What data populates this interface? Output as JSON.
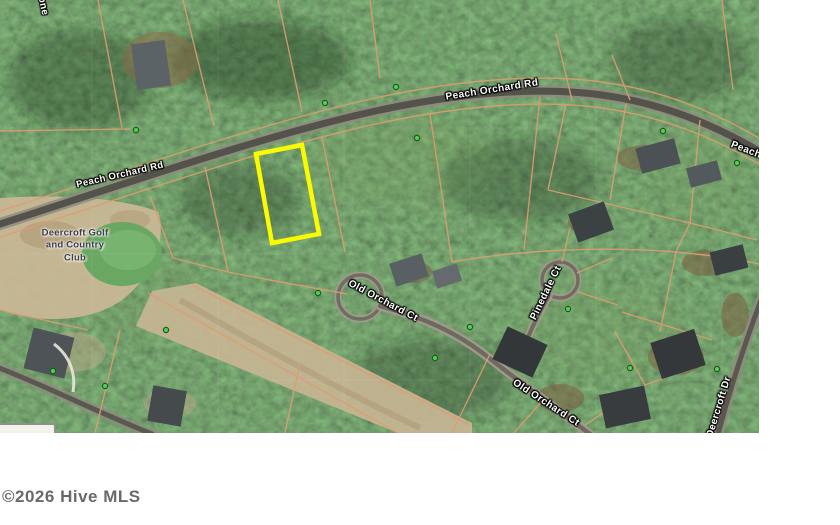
{
  "watermark": {
    "text": "©2026 Hive MLS",
    "color": "#4f4f4f"
  },
  "map": {
    "labels": {
      "partial_top_left": "one",
      "peach_orchard_rd_west": "Peach Orchard Rd",
      "peach_orchard_rd_main": "Peach Orchard Rd",
      "peach_orchard_rd_east_partial": "Peach",
      "old_orchard_ct_upper": "Old Orchard Ct",
      "old_orchard_ct_lower": "Old Orchard Ct",
      "pinedale_ct": "Pinedale Ct",
      "deercroft_dr": "Deercroft Dr",
      "golf_club_line1": "Deercroft Golf",
      "golf_club_line2": "and Country",
      "golf_club_line3": "Club"
    },
    "highlight_lot": {
      "points": "256,154 302,145 319,234 272,243",
      "color": "#fbfb00"
    },
    "colors": {
      "forest": "#33502e",
      "parcel_line": "#dd9d72",
      "road_core": "#504f49",
      "road_casing": "#8f8b7e",
      "sand": "#c8b795",
      "golf_green": "#6aa763",
      "marker_green": "#54d054"
    },
    "green_markers": [
      [
        136,
        130
      ],
      [
        325,
        103
      ],
      [
        396,
        87
      ],
      [
        417,
        138
      ],
      [
        663,
        131
      ],
      [
        737,
        163
      ],
      [
        53,
        371
      ],
      [
        105,
        386
      ],
      [
        166,
        330
      ],
      [
        318,
        293
      ],
      [
        470,
        327
      ],
      [
        435,
        358
      ],
      [
        568,
        309
      ],
      [
        630,
        368
      ],
      [
        717,
        369
      ]
    ]
  }
}
